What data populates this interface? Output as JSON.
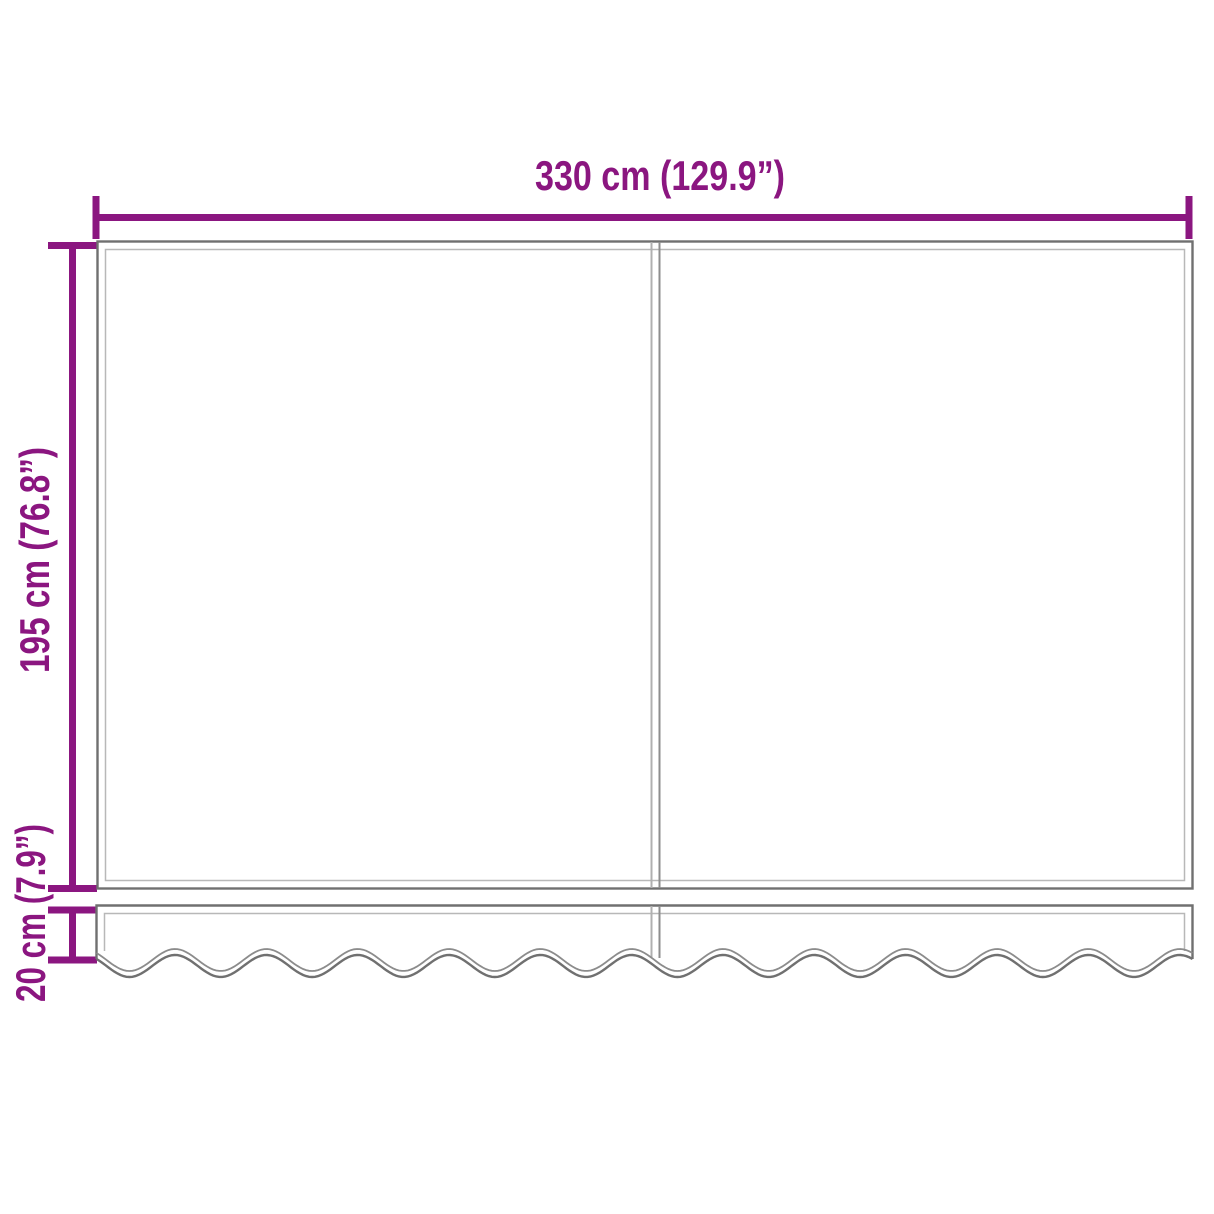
{
  "diagram": {
    "labels": {
      "width": "330 cm (129.9”)",
      "height": "195 cm (76.8”)",
      "valance_height": "20 cm (7.9”)"
    },
    "colors": {
      "dimension": "#8B1680",
      "outline": "#707070",
      "hem": "#B8B8B8",
      "seam_light": "#B0B0B0",
      "seam_dark": "#8E8E8E",
      "wave_inner": "#8C8C8C",
      "background": "#FFFFFF"
    }
  }
}
